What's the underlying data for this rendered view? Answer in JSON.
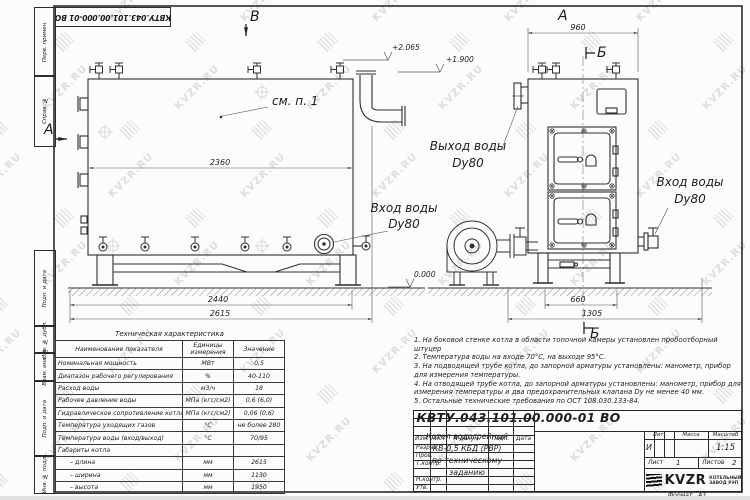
{
  "watermark": {
    "text": "KVZR.RU"
  },
  "doc_number": "КВТУ.043.101.00.000-01 ВО",
  "frame": {
    "stamp_top_1": "Перв. примен.",
    "stamp_top_2": "Справ. №",
    "stamp_b1": "Подп. и дата",
    "stamp_b2": "Инв. № дубл.",
    "stamp_b3": "Взам. инв. №",
    "stamp_b4": "Подп. и дата",
    "stamp_b5": "Инв. № подл.",
    "format_label": "Формат",
    "format_value": "А3"
  },
  "drawing": {
    "sections": {
      "a_left": "А",
      "b_top": "В",
      "a_top_right": "А",
      "b_right": "Б",
      "b_bottom": "Б"
    },
    "callouts": {
      "see_note": "см. п. 1",
      "outlet_title": "Выход воды",
      "outlet_dn": "Dy80",
      "inlet_title": "Вход воды",
      "inlet_dn": "Dy80"
    },
    "dimensions": {
      "body_length": "2360",
      "frame_length": "2440",
      "total_length": "2615",
      "front_width": "960",
      "base_width": "660",
      "total_width": "1305"
    },
    "elevations": {
      "top": "+2.065",
      "mid": "+1.900",
      "zero": "0.000"
    }
  },
  "spec_table": {
    "title": "Техническая характеристика",
    "headers": {
      "name": "Наименование показателя",
      "unit": "Единицы измерения",
      "value": "Значение"
    },
    "rows": [
      {
        "name": "Номинальная мощность",
        "unit": "МВт",
        "value": "0,5"
      },
      {
        "name": "Диапазон рабочего регулирования",
        "unit": "%",
        "value": "40-110"
      },
      {
        "name": "Расход воды",
        "unit": "м3/ч",
        "value": "18"
      },
      {
        "name": "Рабочее давление воды",
        "unit": "МПа (кгс/см2)",
        "value": "0,6 (6,0)"
      },
      {
        "name": "Гидравлическое сопротивление котла",
        "unit": "МПа (кгс/см2)",
        "value": "0,06 (0,6)"
      },
      {
        "name": "Температура уходящих газов",
        "unit": "°С",
        "value": "не более 280"
      },
      {
        "name": "Температура воды (вход/выход)",
        "unit": "°С",
        "value": "70/95"
      },
      {
        "name": "Габариты котла",
        "unit": "",
        "value": ""
      },
      {
        "name": "– длина",
        "unit": "мм",
        "value": "2615"
      },
      {
        "name": "– ширина",
        "unit": "мм",
        "value": "1130"
      },
      {
        "name": "– высота",
        "unit": "мм",
        "value": "1950"
      }
    ]
  },
  "notes": {
    "items": [
      "1. На боковой стенке котла в области топочной камеры установлен пробоотборный штуцер",
      "2. Температура воды на входе 70°С, на выходе 95°С.",
      "3. На подводящей трубе котла, до запорной арматуры установлены: манометр, прибор для измерения температуры.",
      "4. На отводящей трубе котла, до запорной арматуры установлены: манометр, прибор для измерения температуры и два предохранительных клапана Dу не менее 40 мм.",
      "5. Остальные технические требования по ОСТ 108.030.133-84."
    ]
  },
  "title_block": {
    "doc_number": "КВТУ.043.101.00.000-01 ВО",
    "header_cols": [
      "Изм.",
      "Лист",
      "N докум.",
      "Подп.",
      "Дата"
    ],
    "row_labels": [
      "Разраб.",
      "Пров.",
      "Т.контр.",
      "",
      "Н.контр.",
      "Утв."
    ],
    "product_lines": [
      "Котел водогрейный",
      "КВ-0,5 КБД (РВР)",
      "по техническому заданию"
    ],
    "lit_label": "Лит.",
    "lit_value": "И",
    "mass_label": "Масса",
    "scale_label": "Масштаб",
    "scale_value": "1:15",
    "sheet_label": "Лист",
    "sheet_value": "1",
    "sheets_label": "Листов",
    "sheets_value": "2",
    "company_name": "KVZR",
    "company_line1": "КОТЕЛЬНЫЙ",
    "company_line2": "ЗАВОД РЭП"
  }
}
